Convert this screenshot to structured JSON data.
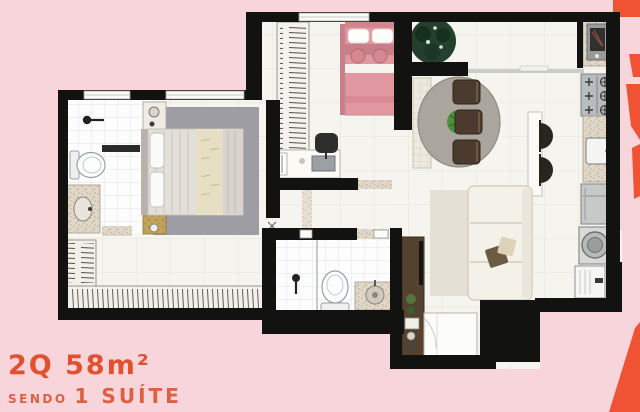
{
  "caption": {
    "line1": "2Q 58m²",
    "line2_prefix": "SENDO",
    "line2_main": "1 SUÍTE"
  },
  "colors": {
    "background": "#f8d5da",
    "accent_coral": "#ef5334",
    "wall": "#121210",
    "floor": "#f6f4ee",
    "bath_tile": "#fdfdfd",
    "rug_gray": "#9d9da3",
    "wood_brown": "#55422e",
    "bed_pink": "#e298a1",
    "sofa_cream": "#f4f1e9",
    "counter_speckle": "#ddd3c4",
    "table_gray": "#aaa69e",
    "chair_brown": "#4b3a2e",
    "plant_dark": "#24402c",
    "plant_green": "#4e8f3c",
    "title_color": "#e3502e",
    "subtitle_color": "#de5f42"
  },
  "icons": {
    "furniture": [
      "double-bed",
      "single-bed",
      "wardrobe",
      "nightstand",
      "desk",
      "desk-chair",
      "dining-table",
      "dining-chair",
      "bench",
      "bar-stool",
      "cooktop",
      "kitchen-sink",
      "prep-sink",
      "refrigerator",
      "washing-machine",
      "laundry-tank",
      "sofa",
      "tv-panel",
      "toilet",
      "shower-head",
      "vanity-sink",
      "plant",
      "rug",
      "entry-door",
      "door-mat",
      "window"
    ]
  }
}
